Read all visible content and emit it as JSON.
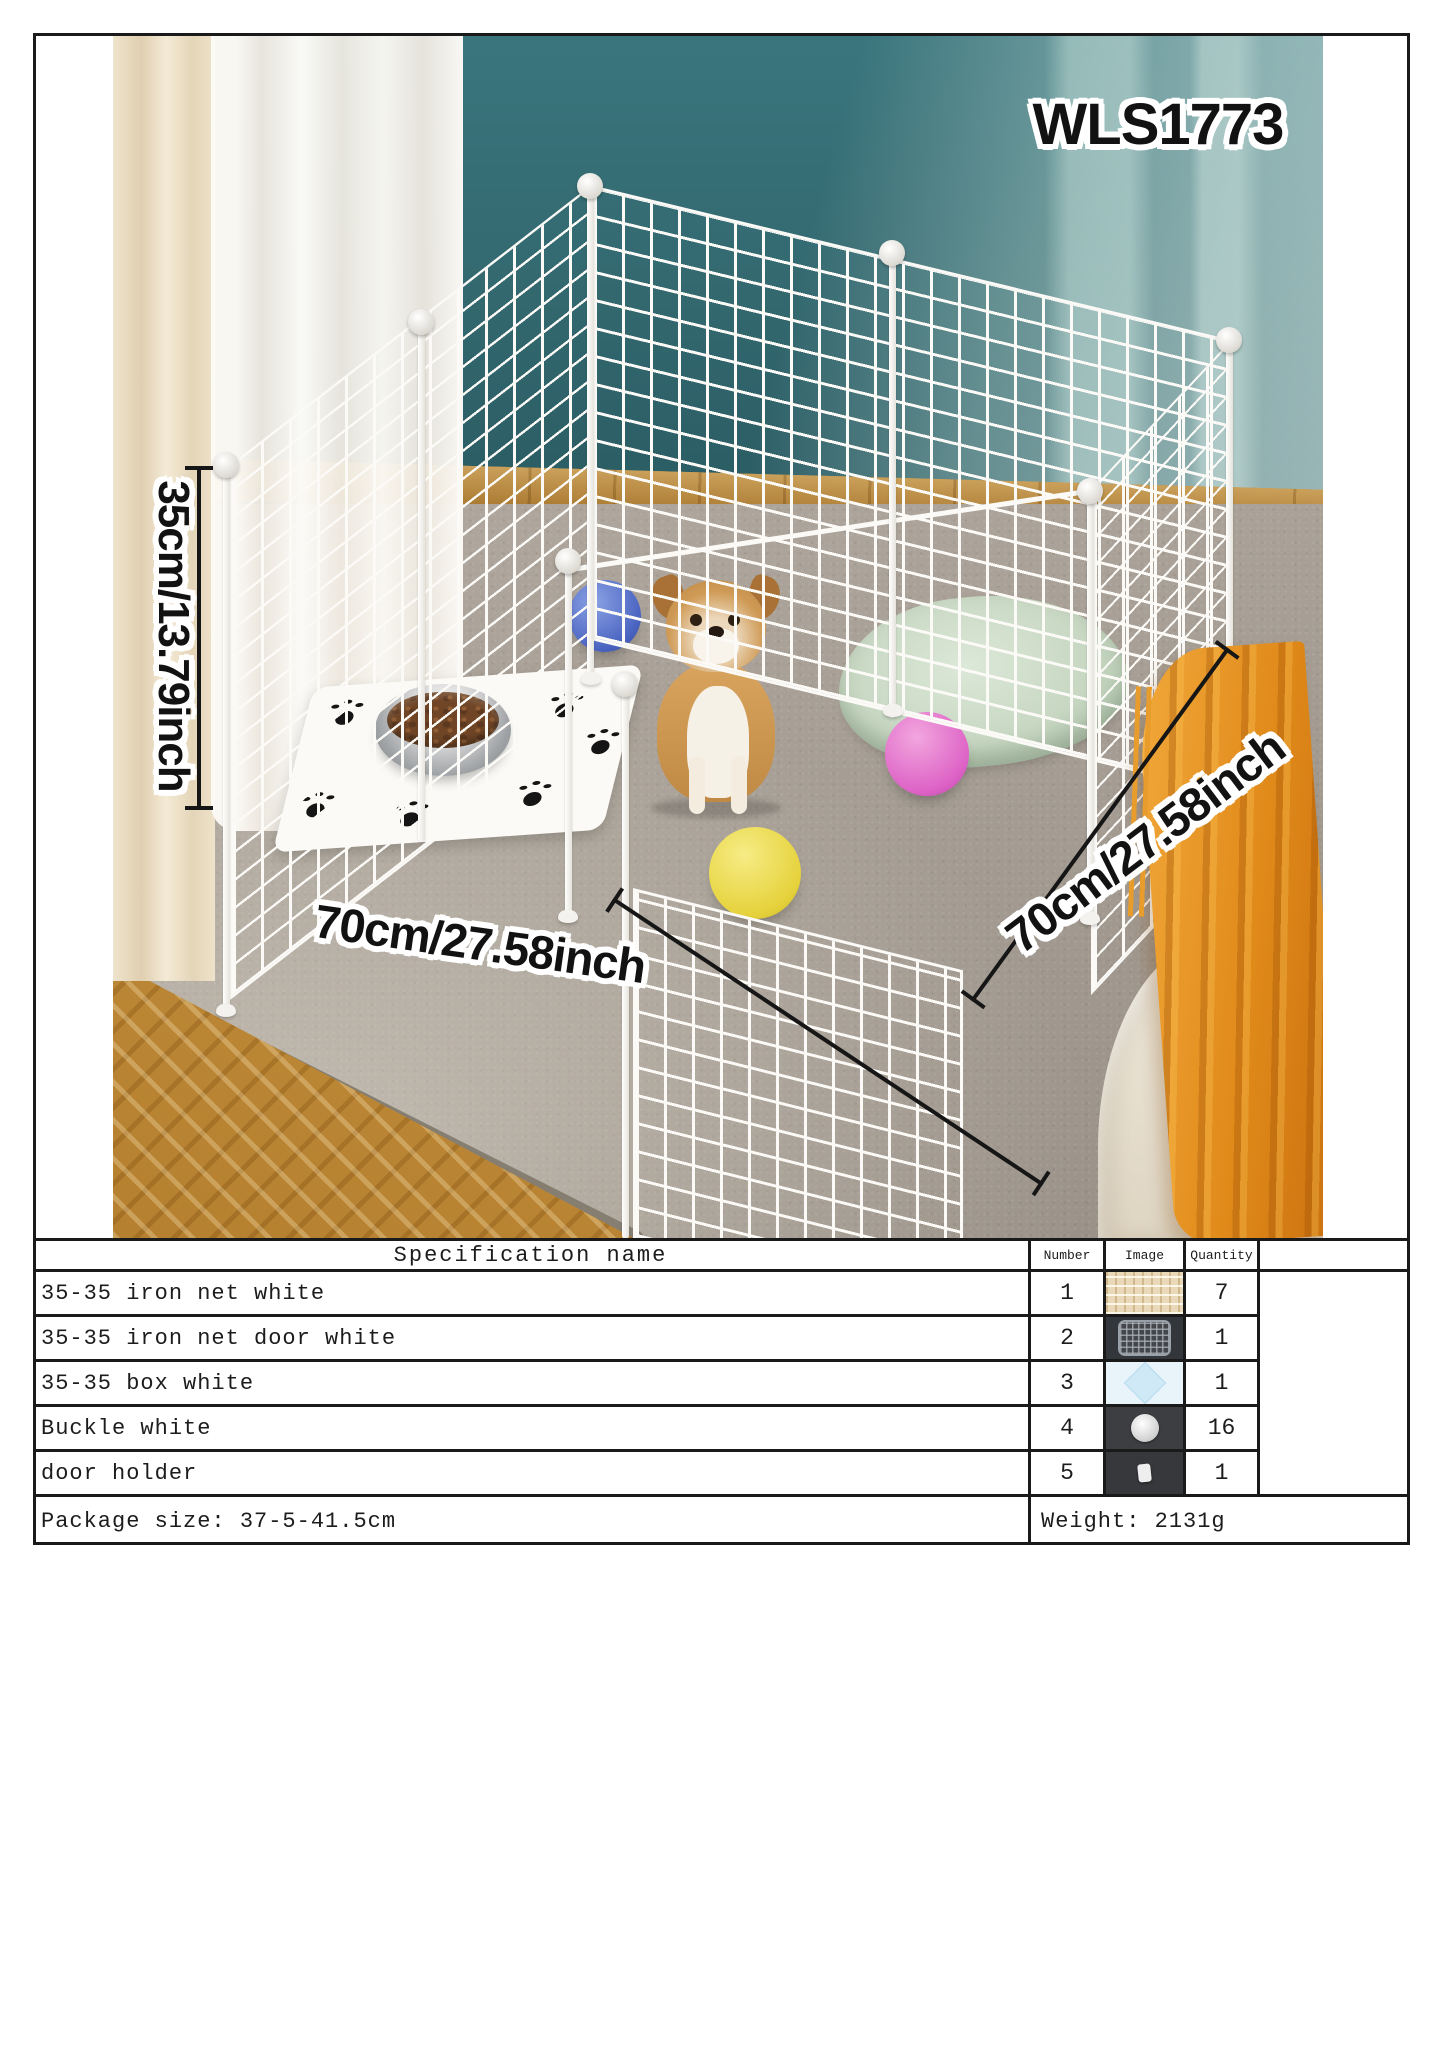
{
  "product": {
    "model_code": "WLS1773"
  },
  "photo_annotations": {
    "height_dimension": "35cm/13.79inch",
    "front_width_dimension": "70cm/27.58inch",
    "side_depth_dimension": "70cm/27.58inch"
  },
  "spec_table": {
    "column_headers": {
      "name": "Specification name",
      "number": "Number",
      "image": "Image",
      "quantity": "Quantity"
    },
    "rows": [
      {
        "name": "35-35 iron net white",
        "number": "1",
        "thumb": "iron-net-white-photo",
        "quantity": "7"
      },
      {
        "name": "35-35 iron net door white",
        "number": "2",
        "thumb": "iron-net-door-photo",
        "quantity": "1"
      },
      {
        "name": "35-35 box white",
        "number": "3",
        "thumb": "box-white-photo",
        "quantity": "1"
      },
      {
        "name": "Buckle white",
        "number": "4",
        "thumb": "buckle-white-photo",
        "quantity": "16"
      },
      {
        "name": "door holder",
        "number": "5",
        "thumb": "door-holder-photo",
        "quantity": "1"
      }
    ],
    "footer": {
      "package_size": "Package size: 37-5-41.5cm",
      "weight": "Weight: 2131g"
    }
  },
  "colors": {
    "wall_teal": "#336b72",
    "rug": "#a89f94",
    "wood_floor": "#c78f3c",
    "curtain_cream": "#eee0c6",
    "pen_wire": "#fbfaf7",
    "ball_blue": "#4a63c0",
    "ball_pink": "#dd62c6",
    "ball_yellow": "#e6d23c",
    "blanket_orange": "#e9992b",
    "pet_bed_green": "#c7d7c2",
    "dog_tan": "#cf9a55",
    "table_border": "#1a1a1a"
  }
}
